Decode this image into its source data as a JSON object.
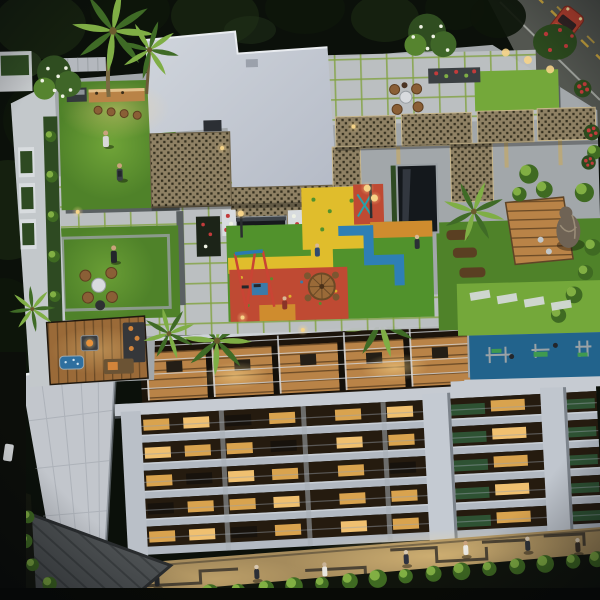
{
  "scene": {
    "description": "Dusk aerial 3D rendering of a residential tower: rooftop amenity terrace with clubhouse, lattice pergola, lawns, kids play area, reflecting pool and outdoor gym; tower facade with green louver bands and lit windows; street promenade with pedestrians below; road with a red car at top right",
    "time_of_day": "dusk"
  },
  "counts": {
    "people_on_roof": 8,
    "people_on_street": 7,
    "palm_trees": 6,
    "vehicles": 2
  },
  "regions": {
    "background": "Tree canopy at dusk",
    "road": "Road with yellow lane markings",
    "vehicle": "Red car",
    "rooftop": "Rooftop amenity terrace",
    "clubhouse": "Clubhouse roof",
    "lattice": "Timber lattice screens",
    "pergola": "Lattice pergola walkway",
    "bar": "Rooftop bar with stools and barbecue",
    "lawn_top": "Barbecue lawn",
    "lawn_seating": "Lawn lounge with wicker chairs",
    "deck_lounge": "Timber deck with fire pit and spa",
    "play_area": "Children's play area",
    "pool": "Reflecting water feature",
    "terrace_seating": "Paved terrace seating",
    "garden": "Edge gardens with palms and sculpture",
    "gym": "Outdoor gym deck",
    "balconies": "Penthouse balconies",
    "facade": "Tower facade with green louvers",
    "fin": "Concrete fin wall",
    "street": "Street promenade with pedestrians",
    "shrubs": "Perimeter planting"
  },
  "palette": {
    "bg-dark": "#0b100a",
    "canopy-dark": "#0d150a",
    "canopy-mid": "#15200f",
    "canopy-lit": "#223219",
    "road": "#535650",
    "road-line": "#c8a43e",
    "road-edge": "#c9ccc6",
    "car-red": "#b5402f",
    "car-roof": "#d06048",
    "roof-top": "#d0d5dc",
    "roof-bottom": "#b4bac6",
    "lattice": "#8f8164",
    "lattice-dark": "#35301f",
    "lattice-frame": "#c7b68c",
    "paver": "#bcc0c2",
    "paver-joint": "#7fa23c",
    "paver-base": "#a2a7aa",
    "path-dark": "#5a6062",
    "lawn": "#4f8229",
    "lawn-lit": "#74a83a",
    "lawn-dark": "#39631e",
    "play-yellow": "#e0bd2c",
    "play-red": "#bf4a33",
    "play-green": "#51922c",
    "play-blue": "#2e7fb5",
    "play-orange": "#cf8c2e",
    "pool": "#14181c",
    "pool-edge": "#9aa0a4",
    "wood": "#9a6a38",
    "wood-lit": "#b98347",
    "wood-dark": "#6b4a26",
    "deck-gray": "#4e5254",
    "deck-gray-line": "#3c4042",
    "parapet": "#c6cbd2",
    "planter-white": "#d8dcdf",
    "hedge": "#2e4a22",
    "gym-blue": "#2a76a4",
    "gym-green": "#3f9a50",
    "equip-gray": "#9aa2a6",
    "facade-slab": "#b2b9c2",
    "facade-recess": "#251b0f",
    "facade-green": "#2e5233",
    "facade-mullion": "#a8aeb7",
    "fin": "#c2c6cc",
    "window-warm": "#d9a34e",
    "window-bright": "#f0c070",
    "street": "#a58b5c",
    "street-pattern": "#3b352b",
    "shrub": "#3f6a22",
    "shrub-lit": "#8dbb49",
    "soil": "#5a3f22",
    "statue": "#6f6355",
    "statue-hi": "#9a8d78",
    "flower-red": "#c23b3b",
    "flower-white": "#eef1e4",
    "light-warm": "#f6d488",
    "sofa-dark": "#35373a",
    "cushion-orange": "#d2843a",
    "tub-blue": "#2e6f9f",
    "white-top": "#d8dbde",
    "wicker": "#8a5f36",
    "railing": "#d5d9de",
    "palm-lit": "#7fae45",
    "palm-dark": "#3f6b26"
  }
}
